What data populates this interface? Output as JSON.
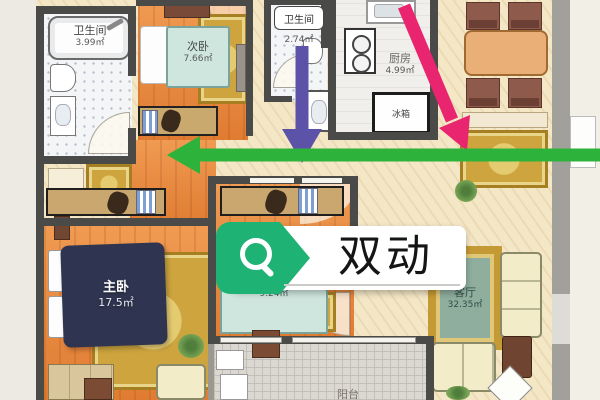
{
  "badge": {
    "label": "双动",
    "tag_color": "#1eb374",
    "icon": "search-magnifier"
  },
  "arrows": {
    "green": {
      "color": "#2db33c",
      "direction": "left"
    },
    "purple": {
      "color": "#5c52a8",
      "direction": "down"
    },
    "pink": {
      "color": "#e8256e",
      "direction": "down-right"
    }
  },
  "rooms": {
    "bathroom_left": {
      "name": "卫生间",
      "area": "3.99㎡"
    },
    "second_bedroom": {
      "name": "次卧",
      "area": "7.66㎡"
    },
    "bathroom_mid": {
      "name": "卫生间",
      "area": "2.74㎡"
    },
    "kitchen": {
      "name": "厨房",
      "area": "4.99㎡"
    },
    "master_bedroom": {
      "name": "主卧",
      "area": "17.5㎡"
    },
    "middle_bedroom": {
      "area": "9.24㎡"
    },
    "living_room": {
      "name": "客厅",
      "area": "32.35㎡"
    },
    "balcony": {
      "name": "阳台"
    }
  },
  "appliances": {
    "fridge_label": "冰箱"
  }
}
